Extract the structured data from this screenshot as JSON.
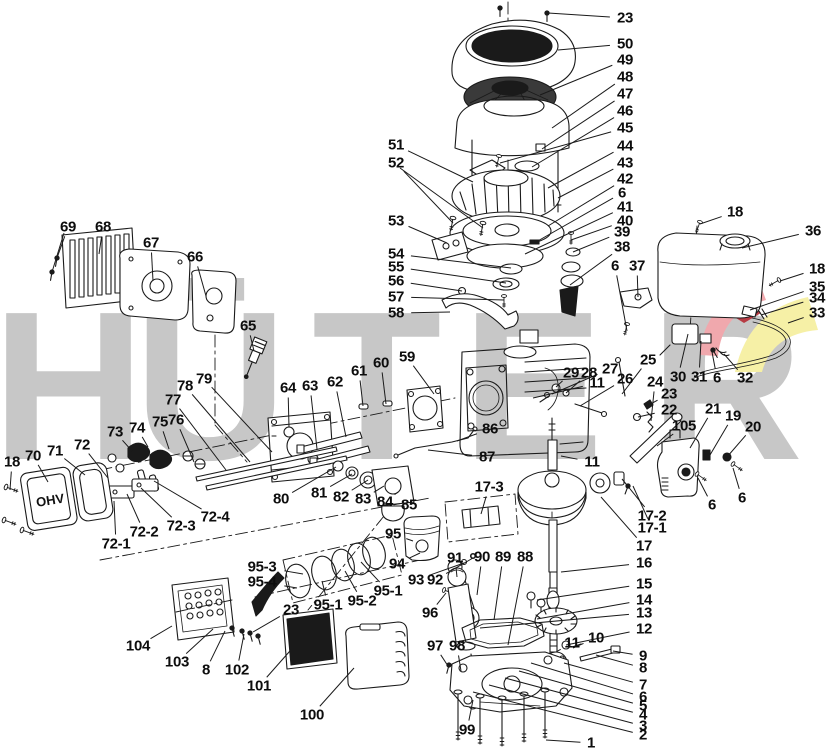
{
  "watermark": {
    "text": "HÜTER",
    "gray": "#c7c7c7",
    "red_light": "#f0a8ad",
    "red_dark": "#b73b44",
    "yellow": "#f6f0a6",
    "letters": [
      {
        "ch": "H",
        "x": -8,
        "y": 280
      },
      {
        "ch": "Ü",
        "x": 134,
        "y": 280
      },
      {
        "ch": "T",
        "x": 312,
        "y": 280
      },
      {
        "ch": "E",
        "x": 462,
        "y": 280
      },
      {
        "ch": "R",
        "x": 650,
        "y": 280
      }
    ]
  },
  "engine": {
    "valve_cover_text": "OHV"
  },
  "labels": [
    [
      "23",
      625,
      18,
      548,
      13
    ],
    [
      "50",
      625,
      44,
      558,
      50
    ],
    [
      "49",
      625,
      60,
      540,
      95
    ],
    [
      "48",
      625,
      77,
      552,
      128
    ],
    [
      "47",
      625,
      94,
      542,
      149
    ],
    [
      "46",
      625,
      111,
      532,
      167
    ],
    [
      "45",
      625,
      128,
      500,
      163
    ],
    [
      "44",
      625,
      146,
      548,
      188
    ],
    [
      "43",
      625,
      163,
      558,
      198
    ],
    [
      "42",
      625,
      179,
      548,
      226
    ],
    [
      "6",
      622,
      193,
      536,
      242
    ],
    [
      "41",
      625,
      207,
      525,
      254
    ],
    [
      "40",
      625,
      221,
      571,
      240
    ],
    [
      "39",
      622,
      232,
      573,
      252
    ],
    [
      "38",
      622,
      247,
      570,
      285
    ],
    [
      "18",
      735,
      212,
      700,
      224
    ],
    [
      "36",
      813,
      231,
      742,
      248
    ],
    [
      "18",
      817,
      269,
      780,
      281
    ],
    [
      "35",
      817,
      287,
      750,
      310
    ],
    [
      "34",
      817,
      298,
      761,
      315
    ],
    [
      "33",
      817,
      313,
      788,
      323
    ],
    [
      "51",
      396,
      145,
      473,
      182
    ],
    [
      "52",
      396,
      163,
      453,
      223
    ],
    [
      "53",
      396,
      221,
      447,
      243
    ],
    [
      "54",
      396,
      254,
      511,
      268
    ],
    [
      "55",
      396,
      267,
      506,
      283
    ],
    [
      "56",
      396,
      281,
      462,
      291
    ],
    [
      "57",
      396,
      297,
      504,
      300
    ],
    [
      "58",
      396,
      313,
      450,
      312
    ],
    [
      "69",
      68,
      227,
      57,
      258
    ],
    [
      "68",
      103,
      227,
      99,
      254
    ],
    [
      "67",
      151,
      243,
      153,
      281
    ],
    [
      "66",
      195,
      257,
      206,
      296
    ],
    [
      "65",
      248,
      326,
      254,
      351
    ],
    [
      "59",
      407,
      357,
      434,
      394
    ],
    [
      "60",
      381,
      363,
      386,
      404
    ],
    [
      "61",
      359,
      371,
      363,
      406
    ],
    [
      "62",
      335,
      382,
      346,
      437
    ],
    [
      "63",
      310,
      386,
      317,
      449
    ],
    [
      "64",
      288,
      388,
      289,
      427
    ],
    [
      "78",
      185,
      386,
      250,
      462
    ],
    [
      "79",
      204,
      379,
      272,
      452
    ],
    [
      "77",
      173,
      400,
      226,
      470
    ],
    [
      "76",
      176,
      420,
      194,
      462
    ],
    [
      "75",
      160,
      422,
      169,
      449
    ],
    [
      "74",
      137,
      428,
      148,
      447
    ],
    [
      "73",
      115,
      432,
      133,
      452
    ],
    [
      "72",
      82,
      445,
      108,
      478
    ],
    [
      "71",
      55,
      451,
      85,
      475
    ],
    [
      "70",
      33,
      456,
      48,
      482
    ],
    [
      "18",
      12,
      462,
      10,
      490
    ],
    [
      "72-1",
      116,
      544,
      114,
      501
    ],
    [
      "72-2",
      144,
      532,
      127,
      494
    ],
    [
      "72-3",
      181,
      526,
      141,
      488
    ],
    [
      "72-4",
      215,
      517,
      154,
      481
    ],
    [
      "80",
      281,
      499,
      336,
      467
    ],
    [
      "81",
      319,
      493,
      352,
      474
    ],
    [
      "82",
      341,
      497,
      368,
      480
    ],
    [
      "83",
      363,
      499,
      384,
      486
    ],
    [
      "84",
      385,
      502,
      398,
      492
    ],
    [
      "85",
      409,
      505,
      404,
      497
    ],
    [
      "86",
      490,
      429,
      457,
      441
    ],
    [
      "87",
      487,
      457,
      428,
      450
    ],
    [
      "29",
      571,
      373,
      556,
      387
    ],
    [
      "28",
      589,
      373,
      566,
      393
    ],
    [
      "27",
      610,
      369,
      552,
      394
    ],
    [
      "11",
      597,
      383,
      533,
      398
    ],
    [
      "26",
      625,
      379,
      580,
      406
    ],
    [
      "25",
      648,
      360,
      622,
      394
    ],
    [
      "24",
      655,
      382,
      651,
      421
    ],
    [
      "30",
      678,
      377,
      688,
      334
    ],
    [
      "31",
      699,
      377,
      701,
      341
    ],
    [
      "6",
      717,
      378,
      712,
      352
    ],
    [
      "32",
      745,
      378,
      724,
      354
    ],
    [
      "23",
      669,
      394,
      647,
      406
    ],
    [
      "22",
      669,
      410,
      638,
      417
    ],
    [
      "21",
      713,
      409,
      690,
      448
    ],
    [
      "105",
      684,
      426,
      657,
      446
    ],
    [
      "19",
      733,
      416,
      710,
      455
    ],
    [
      "20",
      753,
      427,
      727,
      457
    ],
    [
      "6",
      712,
      505,
      698,
      478
    ],
    [
      "6",
      742,
      498,
      733,
      468
    ],
    [
      "6",
      615,
      266,
      627,
      331
    ],
    [
      "37",
      637,
      266,
      638,
      297
    ],
    [
      "17-3",
      489,
      487,
      481,
      514
    ],
    [
      "17-2",
      652,
      516,
      622,
      479
    ],
    [
      "17-1",
      652,
      528,
      633,
      486
    ],
    [
      "17",
      644,
      546,
      601,
      497
    ],
    [
      "16",
      644,
      563,
      561,
      572
    ],
    [
      "15",
      644,
      584,
      537,
      600
    ],
    [
      "14",
      644,
      600,
      537,
      619
    ],
    [
      "13",
      644,
      613,
      480,
      628
    ],
    [
      "12",
      644,
      629,
      566,
      645
    ],
    [
      "9",
      643,
      656,
      613,
      651
    ],
    [
      "8",
      643,
      668,
      596,
      655
    ],
    [
      "7",
      643,
      685,
      564,
      663
    ],
    [
      "6",
      643,
      697,
      531,
      663
    ],
    [
      "5",
      643,
      706,
      519,
      671
    ],
    [
      "4",
      643,
      715,
      505,
      678
    ],
    [
      "3",
      643,
      726,
      489,
      685
    ],
    [
      "2",
      643,
      735,
      473,
      692
    ],
    [
      "1",
      591,
      743,
      546,
      740
    ],
    [
      "11",
      592,
      462,
      561,
      456
    ],
    [
      "11",
      572,
      643,
      556,
      652
    ],
    [
      "10",
      596,
      638,
      573,
      648
    ],
    [
      "95",
      393,
      534,
      413,
      541
    ],
    [
      "94",
      397,
      564,
      420,
      553
    ],
    [
      "95-3",
      262,
      567,
      303,
      574
    ],
    [
      "95-4",
      262,
      582,
      297,
      588
    ],
    [
      "95-1",
      328,
      605,
      322,
      581
    ],
    [
      "95-2",
      362,
      601,
      345,
      571
    ],
    [
      "95-1",
      388,
      591,
      361,
      562
    ],
    [
      "93",
      416,
      580,
      464,
      563
    ],
    [
      "92",
      435,
      580,
      473,
      558
    ],
    [
      "91",
      455,
      558,
      457,
      577
    ],
    [
      "90",
      482,
      557,
      477,
      595
    ],
    [
      "89",
      503,
      557,
      494,
      620
    ],
    [
      "88",
      525,
      557,
      508,
      645
    ],
    [
      "96",
      430,
      613,
      446,
      593
    ],
    [
      "97",
      435,
      646,
      448,
      666
    ],
    [
      "98",
      457,
      646,
      461,
      671
    ],
    [
      "99",
      467,
      730,
      473,
      700
    ],
    [
      "104",
      138,
      646,
      172,
      626
    ],
    [
      "103",
      177,
      662,
      213,
      629
    ],
    [
      "8",
      206,
      670,
      225,
      631
    ],
    [
      "102",
      237,
      670,
      244,
      634
    ],
    [
      "23",
      291,
      610,
      253,
      632
    ],
    [
      "101",
      259,
      686,
      297,
      643
    ],
    [
      "100",
      312,
      715,
      354,
      668
    ]
  ],
  "extra_lines": [
    [
      400,
      168,
      483,
      228
    ],
    [
      64,
      233,
      52,
      272
    ]
  ]
}
